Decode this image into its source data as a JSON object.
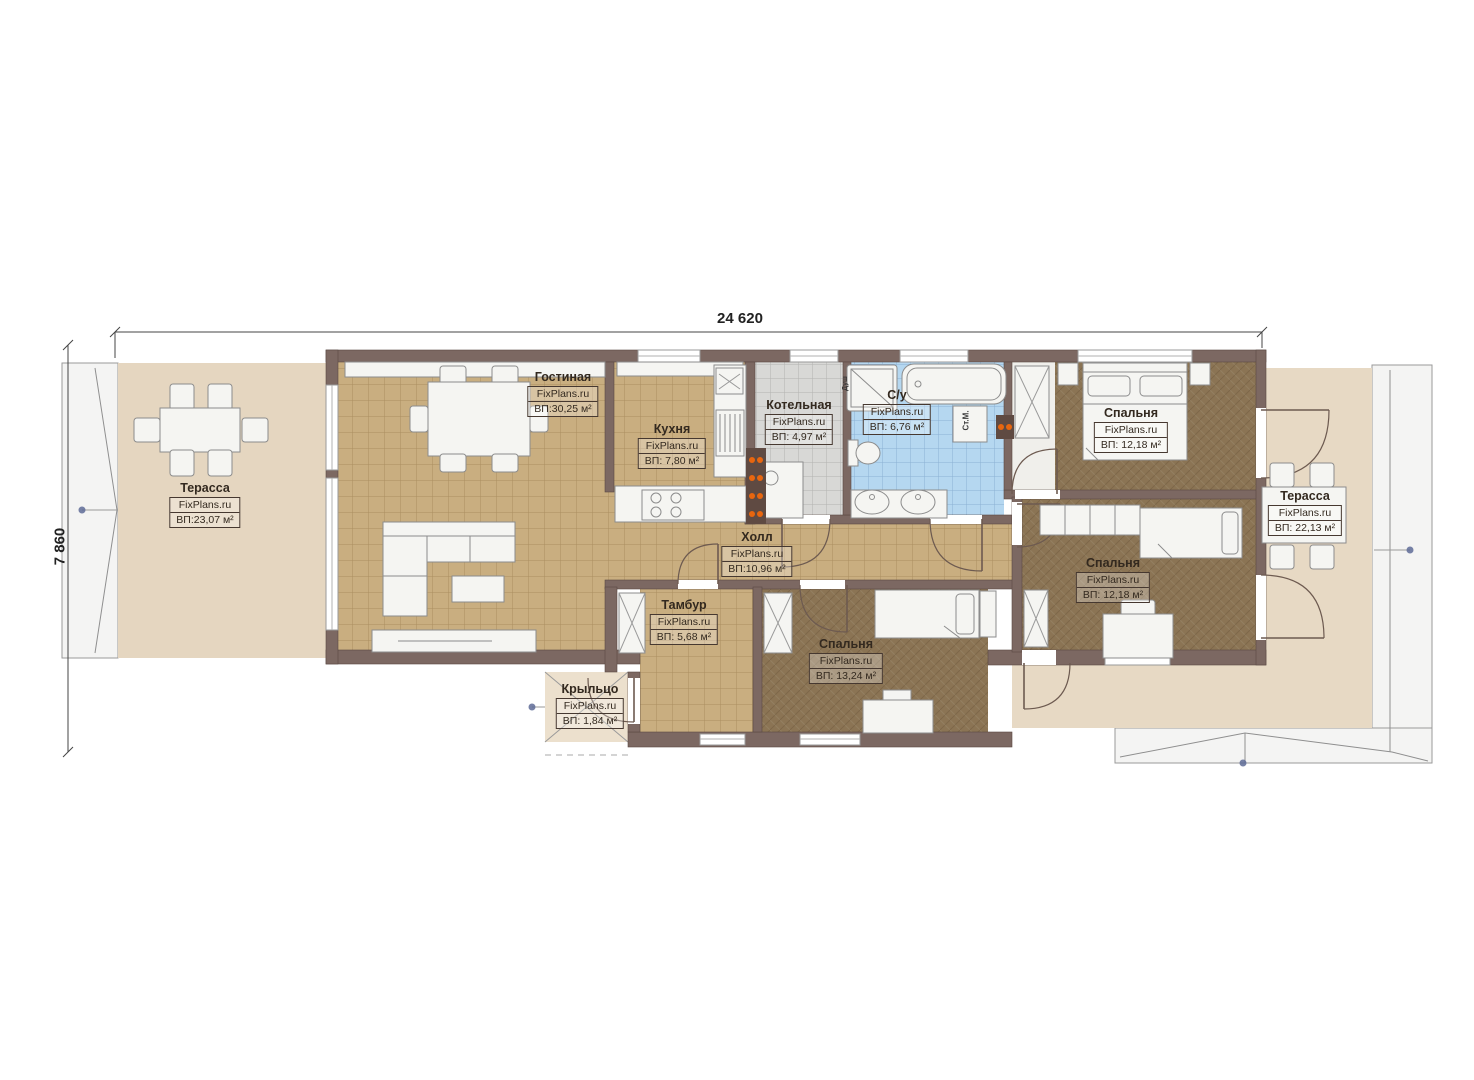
{
  "plan": {
    "brand": "FixPlans.ru",
    "dimensions": {
      "width_label": "24 620",
      "height_label": "7 860"
    },
    "rooms": [
      {
        "id": "terrace-left",
        "name": "Терасса",
        "site": "FixPlans.ru",
        "area": "ВП:23,07 м²"
      },
      {
        "id": "living-room",
        "name": "Гостиная",
        "site": "FixPlans.ru",
        "area": "ВП:30,25 м²"
      },
      {
        "id": "kitchen",
        "name": "Кухня",
        "site": "FixPlans.ru",
        "area": "ВП: 7,80 м²"
      },
      {
        "id": "boiler-room",
        "name": "Котельная",
        "site": "FixPlans.ru",
        "area": "ВП: 4,97 м²"
      },
      {
        "id": "bathroom",
        "name": "С/у",
        "site": "FixPlans.ru",
        "area": "ВП: 6,76 м²"
      },
      {
        "id": "bedroom-top-right",
        "name": "Спальня",
        "site": "FixPlans.ru",
        "area": "ВП: 12,18 м²"
      },
      {
        "id": "terrace-right",
        "name": "Терасса",
        "site": "FixPlans.ru",
        "area": "ВП: 22,13 м²"
      },
      {
        "id": "hall",
        "name": "Холл",
        "site": "FixPlans.ru",
        "area": "ВП:10,96 м²"
      },
      {
        "id": "vestibule",
        "name": "Тамбур",
        "site": "FixPlans.ru",
        "area": "ВП: 5,68 м²"
      },
      {
        "id": "bedroom-mid-right",
        "name": "Спальня",
        "site": "FixPlans.ru",
        "area": "ВП: 12,18 м²"
      },
      {
        "id": "bedroom-bottom",
        "name": "Спальня",
        "site": "FixPlans.ru",
        "area": "ВП: 13,24 м²"
      },
      {
        "id": "porch",
        "name": "Крыльцо",
        "site": "FixPlans.ru",
        "area": "ВП: 1,84 м²"
      }
    ],
    "annotations": {
      "washing_machine": "Ст.М.",
      "shower": "Душ"
    },
    "colors": {
      "wall": "#7c6862",
      "floor_tile": "#c9ae80",
      "floor_wood": "#8b7454",
      "terrace": "#e5d6c0",
      "patio": "#e7d9c4",
      "bathroom": "#b5d7f0",
      "boiler": "#d8d8d6",
      "accent_heat": "#e8660f"
    }
  }
}
